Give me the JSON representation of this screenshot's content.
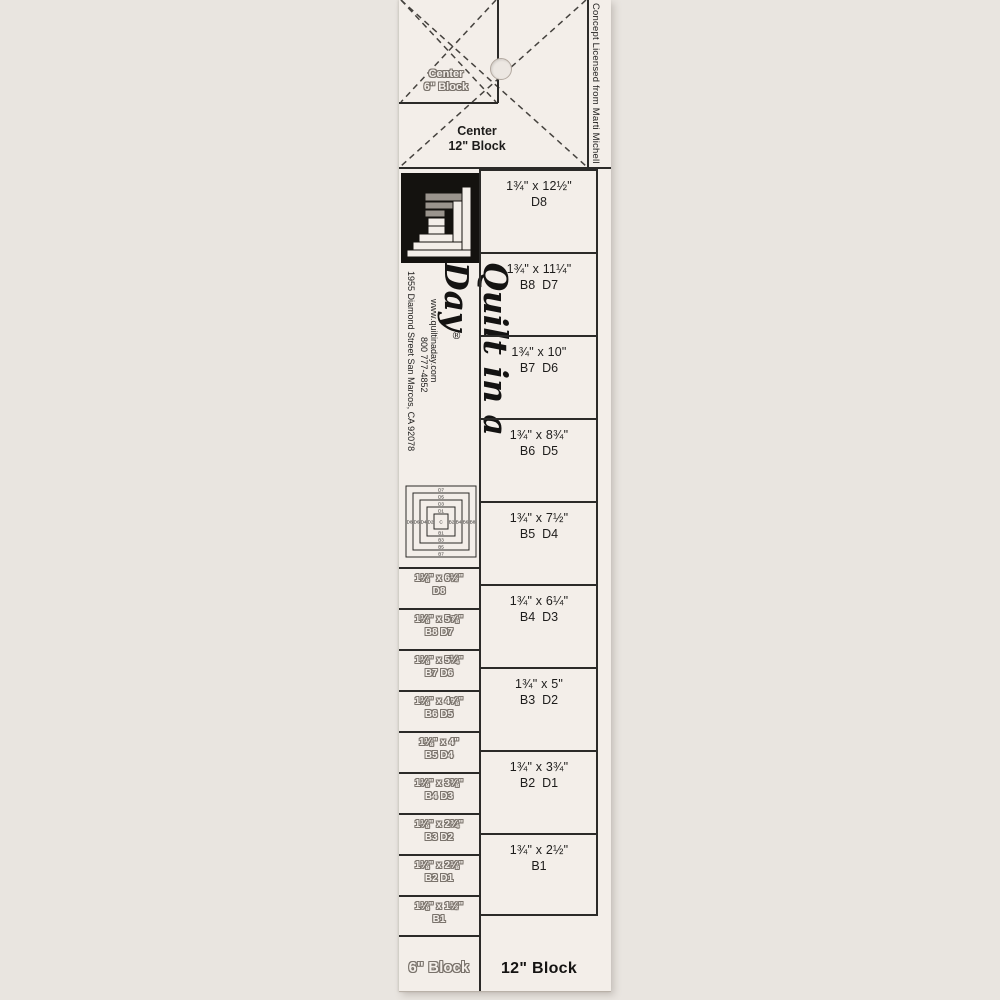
{
  "ruler": {
    "top": {
      "center6_line1": "Center",
      "center6_line2": "6\" Block",
      "center12_line1": "Center",
      "center12_line2": "12\" Block",
      "license": "Concept Licensed from Marti Michell"
    },
    "branding": {
      "script_logo": "Quilt in a Day",
      "registered_mark": "®",
      "address": "1955 Diamond Street San Marcos, CA 92078",
      "website": "www.quiltinaday.com",
      "phone": "800 777-4852"
    },
    "diagram": {
      "center": "C",
      "top_logs": [
        "D7",
        "D5",
        "D3",
        "D1"
      ],
      "bottom_logs": [
        "B1",
        "B3",
        "B5",
        "B7"
      ],
      "left_logs": [
        "D8",
        "D6",
        "D4",
        "D2"
      ],
      "right_logs": [
        "B2",
        "B4",
        "B6",
        "B8"
      ]
    },
    "six_block": {
      "label": "6\" Block",
      "cells": [
        {
          "size": "1⅛\" x 6½\"",
          "codes": "D8"
        },
        {
          "size": "1⅛\" x 5⅞\"",
          "codes": "B8 D7"
        },
        {
          "size": "1⅛\" x 5¼\"",
          "codes": "B7 D6"
        },
        {
          "size": "1⅛\" x 4⅝\"",
          "codes": "B6 D5"
        },
        {
          "size": "1⅛\" x 4\"",
          "codes": "B5 D4"
        },
        {
          "size": "1⅛\" x 3⅜\"",
          "codes": "B4 D3"
        },
        {
          "size": "1⅛\" x 2¾\"",
          "codes": "B3 D2"
        },
        {
          "size": "1⅛\" x 2⅛\"",
          "codes": "B2 D1"
        },
        {
          "size": "1⅛\" x 1½\"",
          "codes": "B1"
        }
      ]
    },
    "twelve_block": {
      "label": "12\" Block",
      "cells": [
        {
          "size": "1¾\" x 12½\"",
          "codes": "D8"
        },
        {
          "size": "1¾\" x 11¼\"",
          "codes": "B8  D7"
        },
        {
          "size": "1¾\" x 10\"",
          "codes": "B7  D6"
        },
        {
          "size": "1¾\" x 8¾\"",
          "codes": "B6  D5"
        },
        {
          "size": "1¾\" x 7½\"",
          "codes": "B5  D4"
        },
        {
          "size": "1¾\" x 6¼\"",
          "codes": "B4  D3"
        },
        {
          "size": "1¾\" x 5\"",
          "codes": "B3  D2"
        },
        {
          "size": "1¾\" x 3¾\"",
          "codes": "B2  D1"
        },
        {
          "size": "1¾\" x 2½\"",
          "codes": "B1"
        }
      ]
    },
    "colors": {
      "surface": "#f3eee9",
      "background": "#e9e5e0",
      "line": "#2b2a28"
    }
  }
}
